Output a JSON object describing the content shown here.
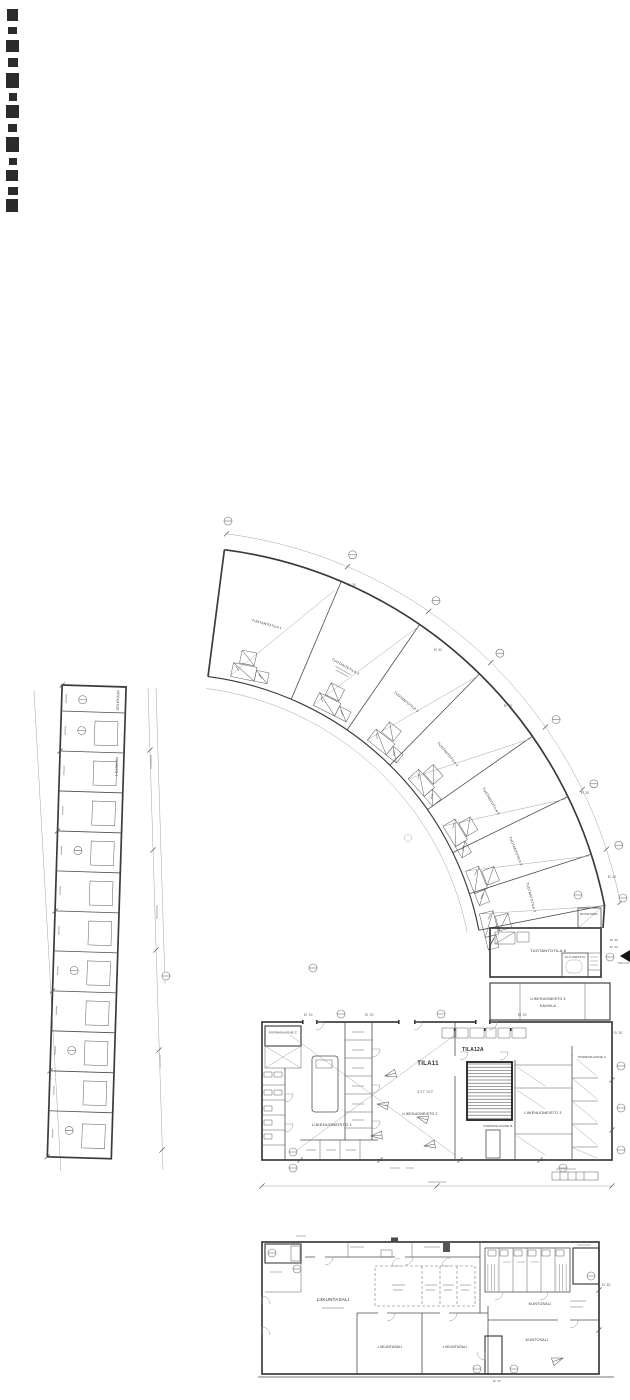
{
  "plan": {
    "storage_strip": {
      "shelter": "JÄTEKATOS",
      "unit": "VARASTO 1"
    },
    "curved_building": {
      "units": [
        "TUOTANTOTILA 1",
        "TUOTANTOTILA 2",
        "TUOTANTOTILA 3",
        "TUOTANTOTILA 4",
        "TUOTANTOTILA 5",
        "TUOTANTOTILA 6",
        "TUOTANTOTILA 7",
        "TUOTANTOTILA 8"
      ],
      "transformer": "MUUNTAMO",
      "oil_storage": "ÖLJYVARASTO",
      "fire_access": "PALOK.",
      "cafe_unit": "LIIKEHUONEISTO 4",
      "cafe": "KAHVILA"
    },
    "main_building": {
      "space11": "TILA11",
      "space11_area": "347 m2",
      "space12a": "TILA12A",
      "unit1": "LIIKEHUONEISTO 1",
      "unit2": "LIIKEHUONEISTO 2",
      "unit3": "LIIKEHUONEISTO 3",
      "stairwell_a": "PORRASHUONE A",
      "stairwell_b": "PORRASHUONE B",
      "stairwell_c": "PORRASHUONE C"
    },
    "sports_building": {
      "hall_main": "LIIKUNTASALI",
      "hall_small_1": "LIIKUNTASALI",
      "hall_small_2": "LIIKUNTASALI",
      "gym_1": "KUNTOSALI",
      "gym_2": "KUNTOSALI"
    },
    "fire_ratings": {
      "ei30": "EI 30",
      "ei60": "EI 60"
    }
  }
}
